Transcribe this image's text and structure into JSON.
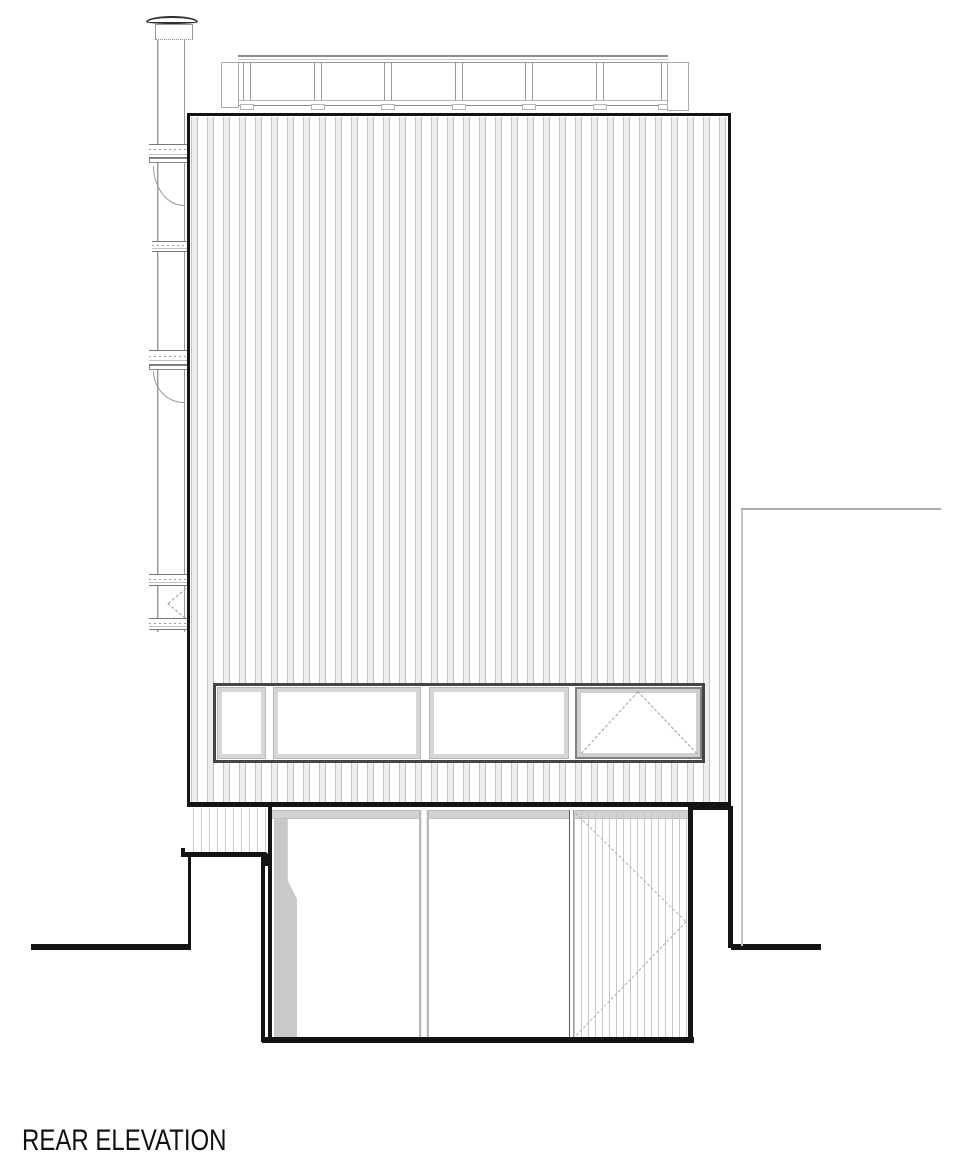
{
  "title": {
    "label": "REAR ELEVATION"
  },
  "drawing": {
    "type": "architectural-elevation",
    "colors": {
      "ink": "#141414",
      "line_medium": "#9a9a9a",
      "line_light": "#cfcfcf",
      "cladding_fill": "#ededed",
      "shadow_fill": "#c9c9c9",
      "background": "#ffffff"
    },
    "elements": {
      "flue": {
        "flange_count": 5,
        "bracket_count": 2
      },
      "roof_railing": {
        "panel_count": 6,
        "post_count": 7
      },
      "upper_window_band": {
        "pane_count": 4,
        "opening_pane": "right pane, top-hung (dashed symbol)"
      },
      "ground_floor": {
        "glazed_pane_count": 2,
        "slatted_gate": true,
        "gate_swing_dashed": true
      }
    }
  }
}
